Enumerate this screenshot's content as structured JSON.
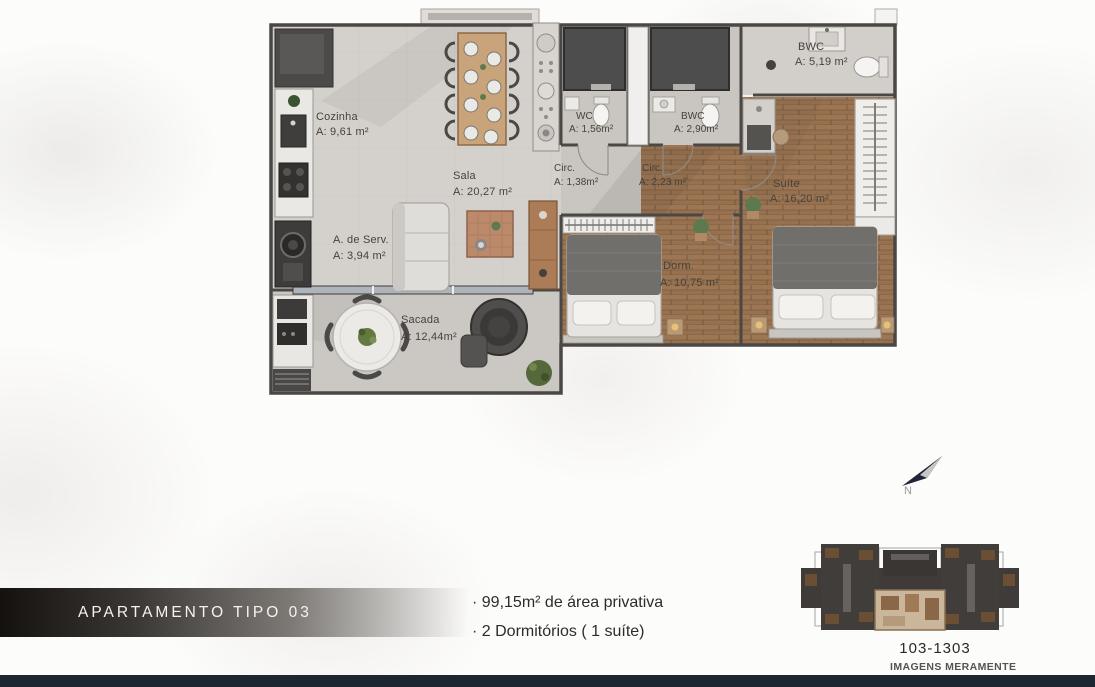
{
  "floor_plan": {
    "rooms": [
      {
        "name": "Cozinha",
        "area": "A: 9,61 m²"
      },
      {
        "name": "Sala",
        "area": "A: 20,27 m²"
      },
      {
        "name": "A. de Serv.",
        "area": "A: 3,94 m²"
      },
      {
        "name": "Sacada",
        "area": "A: 12,44m²"
      },
      {
        "name": "WC",
        "area": "A: 1,56m²"
      },
      {
        "name": "Circ.",
        "area": "A: 1,38m²"
      },
      {
        "name": "BWC",
        "area": "A: 2,90m²"
      },
      {
        "name": "Circ.",
        "area": "A: 2,23 m²"
      },
      {
        "name": "BWC",
        "area": "A: 5,19 m²"
      },
      {
        "name": "Suíte",
        "area": "A: 16,20 m²"
      },
      {
        "name": "Dorm.",
        "area": "A: 10,75 m²"
      }
    ],
    "north_label": "N"
  },
  "info": {
    "title": "APARTAMENTO TIPO 03",
    "bullets": [
      "· 99,15m² de área privativa",
      "· 2 Dormitórios ( 1 suíte)"
    ]
  },
  "keyplan": {
    "caption": "103-1303",
    "disclaimer": "IMAGENS MERAMENTE ILUSTRATIVAS"
  },
  "colors": {
    "footer_bar": "#1d2731",
    "wood_floor": "#96714f",
    "tile_floor": "#d4d1cc",
    "north_arrow_navy": "#20253a"
  }
}
